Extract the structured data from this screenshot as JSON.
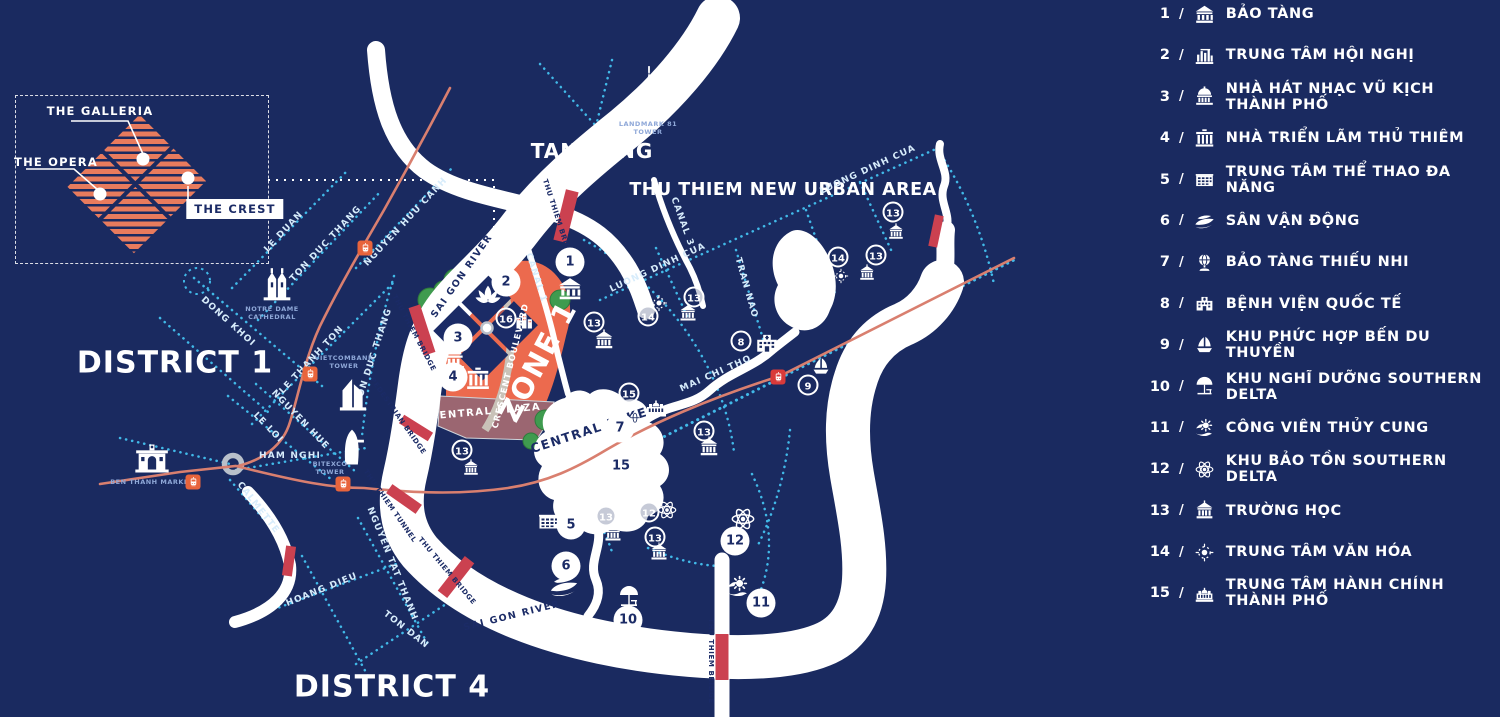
{
  "colors": {
    "background": "#1a2a60",
    "river": "#ffffff",
    "road_dash": "#41b9e8",
    "metro_line": "#d97f6f",
    "bridge": "#cb4150",
    "zone_fill": "#ec6a4e",
    "plaza_fill": "#9b6671",
    "green": "#3f9b4f",
    "tram_orange": "#e8643c",
    "tram_red": "#d93a3a",
    "hatch_orange": "#e87b5d"
  },
  "inset": {
    "labels": {
      "galleria": "THE GALLERIA",
      "opera": "THE OPERA",
      "crest": "THE CREST"
    }
  },
  "legend": {
    "separator": "/",
    "items": [
      {
        "num": "1",
        "icon": "museum-icon",
        "label": "BẢO TÀNG"
      },
      {
        "num": "2",
        "icon": "convention-icon",
        "label": "TRUNG TÂM HỘI NGHỊ"
      },
      {
        "num": "3",
        "icon": "opera-icon",
        "label": "NHÀ HÁT NHẠC VŨ KỊCH THÀNH PHỐ"
      },
      {
        "num": "4",
        "icon": "gate-icon",
        "label": "NHÀ TRIỂN LÃM THỦ THIÊM"
      },
      {
        "num": "5",
        "icon": "sports-icon",
        "label": "TRUNG TÂM THỂ THAO ĐA NĂNG"
      },
      {
        "num": "6",
        "icon": "stadium-icon",
        "label": "SÂN VẬN ĐỘNG"
      },
      {
        "num": "7",
        "icon": "globe-icon",
        "label": "BẢO TÀNG THIẾU NHI"
      },
      {
        "num": "8",
        "icon": "hospital-icon",
        "label": "BỆNH VIỆN QUỐC TẾ"
      },
      {
        "num": "9",
        "icon": "sailboat-icon",
        "label": "KHU PHỨC HỢP BẾN DU THUYỀN"
      },
      {
        "num": "10",
        "icon": "umbrella-icon",
        "label": "KHU NGHĨ DƯỠNG SOUTHERN DELTA"
      },
      {
        "num": "11",
        "icon": "aquarium-icon",
        "label": "CÔNG VIÊN THỦY CUNG"
      },
      {
        "num": "12",
        "icon": "atom-icon",
        "label": "KHU BẢO TỒN SOUTHERN DELTA"
      },
      {
        "num": "13",
        "icon": "school-icon",
        "label": "TRƯỜNG HỌC"
      },
      {
        "num": "14",
        "icon": "sun-icon",
        "label": "TRUNG TÂM VĂN HÓA"
      },
      {
        "num": "15",
        "icon": "cityhall-icon",
        "label": "TRUNG TÂM HÀNH CHÍNH THÀNH PHỐ"
      }
    ]
  },
  "map": {
    "area_labels": [
      {
        "text": "DISTRICT 1",
        "x": 175,
        "y": 363,
        "size": 30,
        "rot": 0,
        "navy": false,
        "ls": 1
      },
      {
        "text": "DISTRICT 4",
        "x": 392,
        "y": 687,
        "size": 30,
        "rot": 0,
        "navy": false,
        "ls": 1
      },
      {
        "text": "TAN CANG",
        "x": 592,
        "y": 151,
        "size": 20,
        "rot": 0,
        "navy": false,
        "ls": 1
      },
      {
        "text": "THU THIEM NEW URBAN AREA",
        "x": 783,
        "y": 190,
        "size": 17.5,
        "rot": 0,
        "navy": false,
        "ls": 0.5
      },
      {
        "text": "ZONE 1",
        "x": 538,
        "y": 361,
        "size": 29,
        "rot": -62,
        "navy": false,
        "ls": 2
      },
      {
        "text": "CRESCENT BOULEVARD",
        "x": 511,
        "y": 366,
        "size": 8.5,
        "rot": -76,
        "navy": false,
        "ls": 1
      },
      {
        "text": "CENTRAL PLAZA",
        "x": 486,
        "y": 412,
        "size": 10,
        "rot": -5,
        "navy": false,
        "ls": 1.5
      },
      {
        "text": "CENTRAL LAKE",
        "x": 589,
        "y": 430,
        "size": 12.5,
        "rot": -18,
        "navy": true,
        "ls": 1.5
      }
    ],
    "street_labels": [
      {
        "text": "LE DUAN",
        "x": 284,
        "y": 232,
        "rot": -47,
        "cls": ""
      },
      {
        "text": "TON DUC THANG",
        "x": 326,
        "y": 244,
        "rot": -47,
        "cls": ""
      },
      {
        "text": "NGUYEN HUU CANH",
        "x": 406,
        "y": 222,
        "rot": -47,
        "cls": ""
      },
      {
        "text": "DONG KHOI",
        "x": 228,
        "y": 322,
        "rot": 42,
        "cls": ""
      },
      {
        "text": "LE THANH TON",
        "x": 312,
        "y": 360,
        "rot": -47,
        "cls": ""
      },
      {
        "text": "TON DUC THANG",
        "x": 374,
        "y": 356,
        "rot": -72,
        "cls": ""
      },
      {
        "text": "LE LOI",
        "x": 268,
        "y": 428,
        "rot": 46,
        "cls": ""
      },
      {
        "text": "NGUYEN HUE",
        "x": 300,
        "y": 420,
        "rot": 46,
        "cls": ""
      },
      {
        "text": "HAM NGHI",
        "x": 290,
        "y": 456,
        "rot": 0,
        "cls": ""
      },
      {
        "text": "CALMETTE",
        "x": 258,
        "y": 508,
        "rot": 52,
        "cls": ""
      },
      {
        "text": "HOANG DIEU",
        "x": 322,
        "y": 590,
        "rot": -22,
        "cls": ""
      },
      {
        "text": "NGUYEN TAT THANH",
        "x": 392,
        "y": 564,
        "rot": 68,
        "cls": ""
      },
      {
        "text": "TON DAN",
        "x": 406,
        "y": 630,
        "rot": 38,
        "cls": ""
      },
      {
        "text": "SAI GON RIVER",
        "x": 462,
        "y": 276,
        "rot": -55,
        "cls": "river"
      },
      {
        "text": "SAI GON RIVER",
        "x": 512,
        "y": 616,
        "rot": -14,
        "cls": "river"
      },
      {
        "text": "CANAL 1",
        "x": 536,
        "y": 278,
        "rot": 72,
        "cls": ""
      },
      {
        "text": "CANAL 3",
        "x": 682,
        "y": 222,
        "rot": 70,
        "cls": ""
      },
      {
        "text": "LUONG DINH CUA",
        "x": 658,
        "y": 268,
        "rot": -25,
        "cls": ""
      },
      {
        "text": "LUONG DINH CUA",
        "x": 868,
        "y": 170,
        "rot": -25,
        "cls": ""
      },
      {
        "text": "TRAN NAO",
        "x": 746,
        "y": 288,
        "rot": 74,
        "cls": ""
      },
      {
        "text": "MAI CHI THO",
        "x": 716,
        "y": 374,
        "rot": -24,
        "cls": ""
      },
      {
        "text": "THU THIEM BRIDGE",
        "x": 558,
        "y": 220,
        "rot": 72,
        "cls": "navy"
      },
      {
        "text": "THU THIEM BRIDGE",
        "x": 414,
        "y": 333,
        "rot": 62,
        "cls": "navy"
      },
      {
        "text": "PEDESTRIAN BRIDGE",
        "x": 398,
        "y": 416,
        "rot": 55,
        "cls": "navy"
      },
      {
        "text": "THU THIEM TUNNEL",
        "x": 390,
        "y": 506,
        "rot": 55,
        "cls": "navy"
      },
      {
        "text": "THU THIEM BRIDGE",
        "x": 447,
        "y": 571,
        "rot": 50,
        "cls": "navy"
      },
      {
        "text": "THU THIEM BRIDGE",
        "x": 711,
        "y": 661,
        "rot": 90,
        "cls": "navy"
      }
    ],
    "markers": [
      {
        "num": "1",
        "x": 570,
        "y": 262,
        "style": "solid"
      },
      {
        "num": "2",
        "x": 506,
        "y": 282,
        "style": "solid"
      },
      {
        "num": "3",
        "x": 458,
        "y": 338,
        "style": "solid"
      },
      {
        "num": "4",
        "x": 453,
        "y": 377,
        "style": "solid"
      },
      {
        "num": "5",
        "x": 571,
        "y": 525,
        "style": "solid"
      },
      {
        "num": "6",
        "x": 566,
        "y": 566,
        "style": "solid"
      },
      {
        "num": "7",
        "x": 620,
        "y": 428,
        "style": "solid"
      },
      {
        "num": "10",
        "x": 628,
        "y": 620,
        "style": "solid"
      },
      {
        "num": "11",
        "x": 761,
        "y": 603,
        "style": "solid"
      },
      {
        "num": "12",
        "x": 735,
        "y": 541,
        "style": "solid"
      },
      {
        "num": "15",
        "x": 621,
        "y": 466,
        "style": "solid"
      },
      {
        "num": "16",
        "x": 506,
        "y": 318,
        "style": "outline"
      },
      {
        "num": "13",
        "x": 594,
        "y": 322,
        "style": "outline"
      },
      {
        "num": "14",
        "x": 648,
        "y": 316,
        "style": "outline"
      },
      {
        "num": "13",
        "x": 694,
        "y": 297,
        "style": "outline"
      },
      {
        "num": "8",
        "x": 741,
        "y": 341,
        "style": "outline"
      },
      {
        "num": "9",
        "x": 808,
        "y": 385,
        "style": "outline"
      },
      {
        "num": "15",
        "x": 629,
        "y": 393,
        "style": "outline"
      },
      {
        "num": "13",
        "x": 704,
        "y": 431,
        "style": "outline"
      },
      {
        "num": "13",
        "x": 606,
        "y": 516,
        "style": "outline"
      },
      {
        "num": "13",
        "x": 655,
        "y": 537,
        "style": "outline"
      },
      {
        "num": "12",
        "x": 649,
        "y": 512,
        "style": "outline"
      },
      {
        "num": "14",
        "x": 838,
        "y": 257,
        "style": "outline"
      },
      {
        "num": "13",
        "x": 876,
        "y": 255,
        "style": "outline"
      },
      {
        "num": "13",
        "x": 893,
        "y": 212,
        "style": "outline"
      },
      {
        "num": "13",
        "x": 462,
        "y": 450,
        "style": "outline"
      }
    ],
    "poi_icons": [
      {
        "icon": "museum-icon",
        "x": 570,
        "y": 289,
        "size": 26
      },
      {
        "icon": "lotus-icon",
        "x": 488,
        "y": 297,
        "size": 30
      },
      {
        "icon": "buildings-icon",
        "x": 524,
        "y": 321,
        "size": 20
      },
      {
        "icon": "opera-icon",
        "x": 452,
        "y": 357,
        "size": 30
      },
      {
        "icon": "gate-icon",
        "x": 478,
        "y": 379,
        "size": 26
      },
      {
        "icon": "school-icon",
        "x": 604,
        "y": 340,
        "size": 22
      },
      {
        "icon": "school-icon",
        "x": 688,
        "y": 313,
        "size": 20
      },
      {
        "icon": "school-icon",
        "x": 709,
        "y": 447,
        "size": 22
      },
      {
        "icon": "school-icon",
        "x": 613,
        "y": 533,
        "size": 20
      },
      {
        "icon": "school-icon",
        "x": 659,
        "y": 552,
        "size": 20
      },
      {
        "icon": "school-icon",
        "x": 867,
        "y": 273,
        "size": 18
      },
      {
        "icon": "school-icon",
        "x": 896,
        "y": 232,
        "size": 18
      },
      {
        "icon": "school-icon",
        "x": 471,
        "y": 468,
        "size": 18
      },
      {
        "icon": "sun-icon",
        "x": 659,
        "y": 303,
        "size": 19
      },
      {
        "icon": "sun-icon",
        "x": 841,
        "y": 276,
        "size": 17
      },
      {
        "icon": "hospital-icon",
        "x": 767,
        "y": 343,
        "size": 26
      },
      {
        "icon": "sailboat-icon",
        "x": 821,
        "y": 367,
        "size": 21
      },
      {
        "icon": "globe-icon",
        "x": 635,
        "y": 420,
        "size": 18
      },
      {
        "icon": "cityhall-icon",
        "x": 656,
        "y": 407,
        "size": 24
      },
      {
        "icon": "atom-icon",
        "x": 667,
        "y": 510,
        "size": 22
      },
      {
        "icon": "atom-icon",
        "x": 743,
        "y": 519,
        "size": 27
      },
      {
        "icon": "sports-icon",
        "x": 549,
        "y": 521,
        "size": 24
      },
      {
        "icon": "stadium-icon",
        "x": 564,
        "y": 585,
        "size": 30
      },
      {
        "icon": "umbrella-icon",
        "x": 629,
        "y": 597,
        "size": 24
      },
      {
        "icon": "aquarium-icon",
        "x": 738,
        "y": 586,
        "size": 25
      }
    ],
    "landmarks": [
      {
        "icon": "church-icon",
        "x": 277,
        "y": 284,
        "size": 40,
        "label": "NOTRE DAME\nCATHEDRAL",
        "lx": 272,
        "ly": 313
      },
      {
        "icon": "vcb-tower-icon",
        "x": 353,
        "y": 393,
        "size": 42,
        "label": "VIETCOMBANK\nTOWER",
        "lx": 344,
        "ly": 362
      },
      {
        "icon": "bitexco-tower-icon",
        "x": 352,
        "y": 448,
        "size": 44,
        "label": "BITEXCO\nTOWER",
        "lx": 330,
        "ly": 468
      },
      {
        "icon": "market-icon",
        "x": 152,
        "y": 457,
        "size": 40,
        "label": "BEN THANH MARKET",
        "lx": 152,
        "ly": 482
      },
      {
        "icon": "landmark81-icon",
        "x": 649,
        "y": 92,
        "size": 54,
        "label": "LANDMARK 81\nTOWER",
        "lx": 648,
        "ly": 128
      }
    ],
    "trams": [
      {
        "x": 365,
        "y": 248,
        "color": "orange"
      },
      {
        "x": 310,
        "y": 374,
        "color": "orange"
      },
      {
        "x": 343,
        "y": 484,
        "color": "orange"
      },
      {
        "x": 193,
        "y": 482,
        "color": "orange"
      },
      {
        "x": 778,
        "y": 377,
        "color": "red"
      }
    ]
  }
}
